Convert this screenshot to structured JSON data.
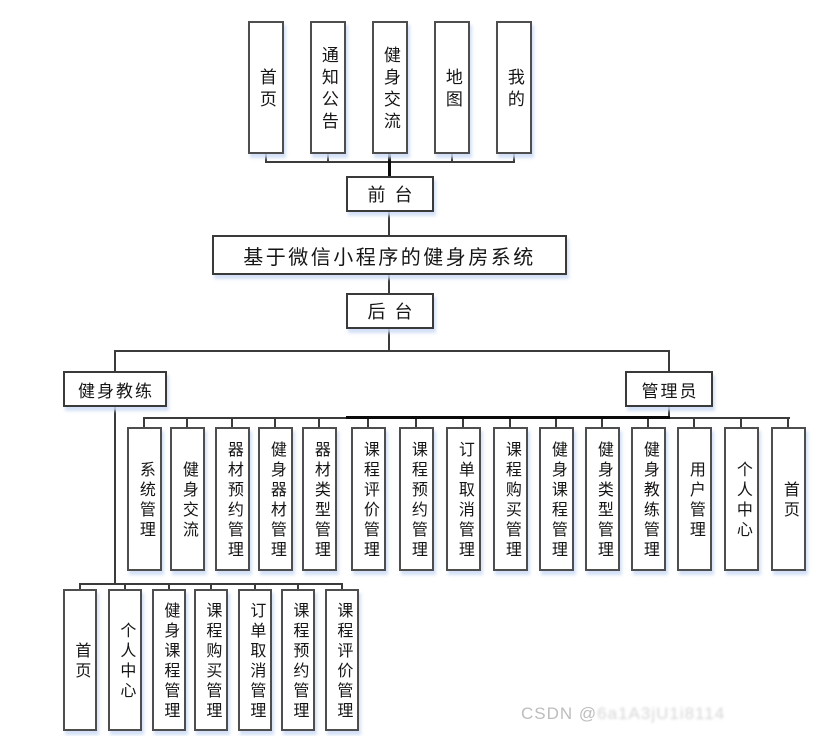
{
  "nodes": {
    "root": "基于微信小程序的健身房系统",
    "front_portal": "前台",
    "back_portal": "后台",
    "coach": "健身教练",
    "admin": "管理员",
    "front_children": [
      "首页",
      "通知公告",
      "健身交流",
      "地图",
      "我的"
    ],
    "admin_children": [
      "系统管理",
      "健身交流",
      "器材预约管理",
      "健身器材管理",
      "器材类型管理",
      "课程评价管理",
      "课程预约管理",
      "订单取消管理",
      "课程购买管理",
      "健身课程管理",
      "健身类型管理",
      "健身教练管理",
      "用户管理",
      "个人中心",
      "首页"
    ],
    "coach_children": [
      "首页",
      "个人中心",
      "健身课程管理",
      "课程购买管理",
      "订单取消管理",
      "课程预约管理",
      "课程评价管理"
    ]
  },
  "watermark": {
    "brand": "CSDN @",
    "author": "6a1A3jU1i8114"
  },
  "colors": {
    "line": "#3b3b3b",
    "box_border": "#4e4e4e",
    "text": "#151515",
    "shadow": "#dce5f7",
    "watermark": "#bdbdc0"
  }
}
